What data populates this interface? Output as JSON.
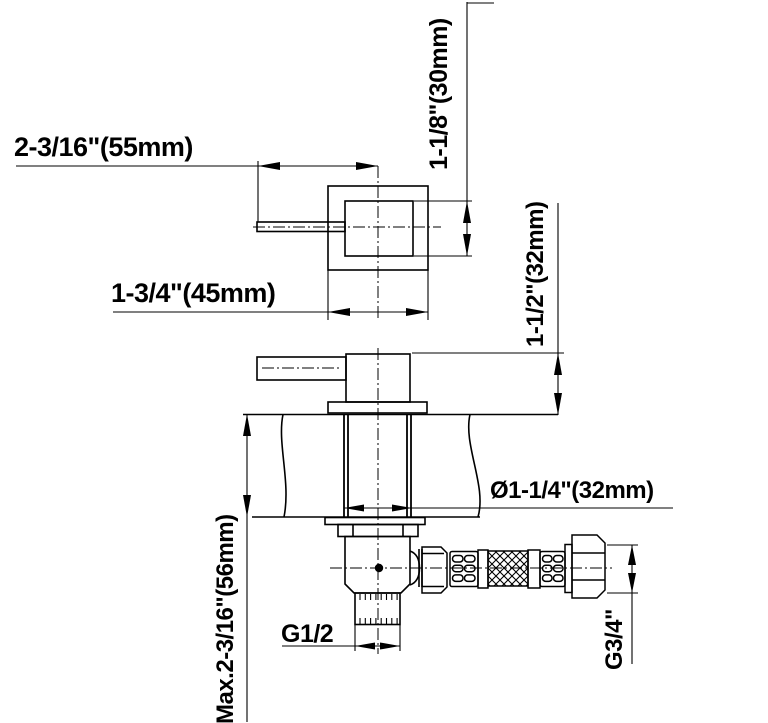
{
  "drawing_type": "faucet-valve-installation-dimension-drawing",
  "colors": {
    "line": "#000000",
    "background": "#ffffff"
  },
  "views": {
    "top_view": "handle-and-square-escutcheon-plan",
    "side_view": "valve-through-wall-with-braided-hose"
  },
  "labels": {
    "handle_length": "2-3/16\"(55mm)",
    "body_width": "1-3/4\"(45mm)",
    "body_height": "1-1/8\"(30mm)",
    "body_depth": "1-1/2\"(32mm)",
    "hole_diameter": "Ø1-1/4\"(32mm)",
    "max_wall_thickness": "Max.2-3/16\"(56mm)",
    "outlet_thread": "G1/2",
    "hose_thread": "G3/4\""
  }
}
